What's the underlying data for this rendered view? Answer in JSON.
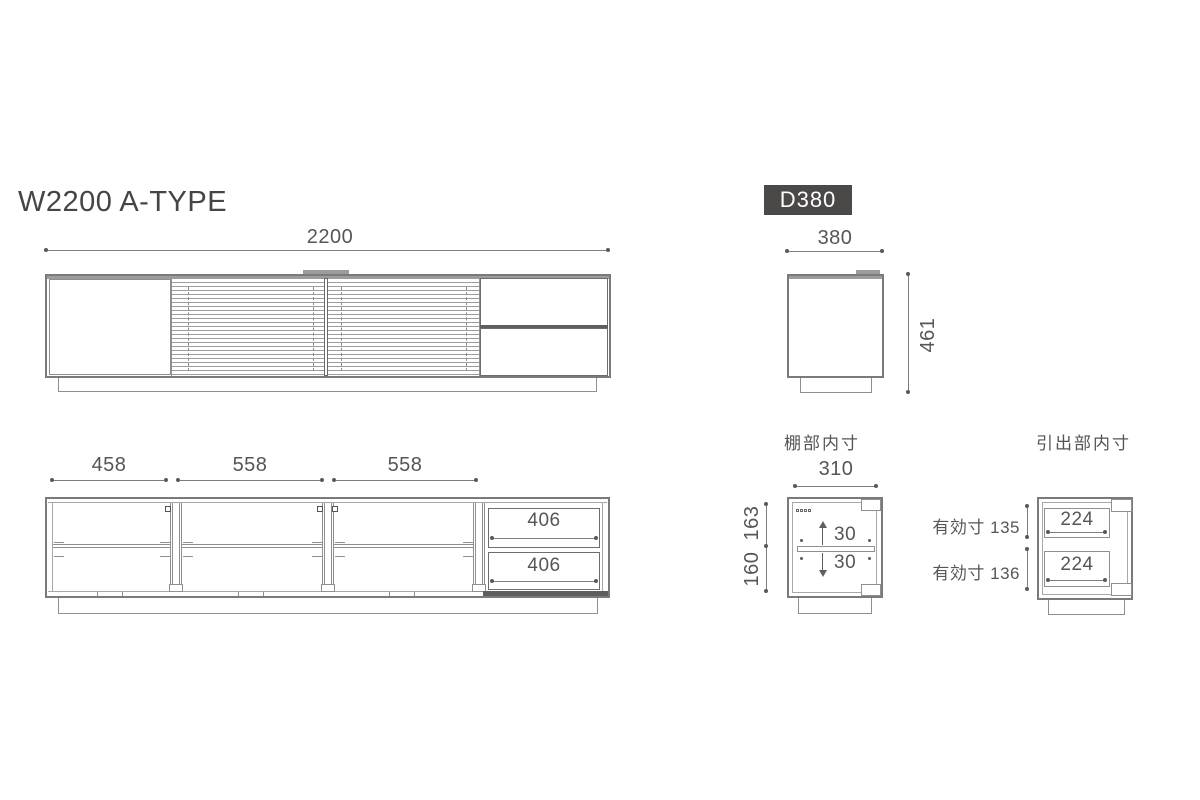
{
  "colors": {
    "line": "#8f8f8f",
    "dark_line": "#5f5f5f",
    "text": "#565656",
    "badge_bg": "#4b4848",
    "badge_text": "#ffffff"
  },
  "header": {
    "title": "W2200 A-TYPE",
    "badge": "D380"
  },
  "front_view": {
    "overall_width": "2200"
  },
  "front_internal": {
    "compartments": [
      "458",
      "558",
      "558"
    ],
    "drawers": [
      "406",
      "406"
    ]
  },
  "side_view": {
    "depth": "380",
    "height": "461"
  },
  "shelf_detail": {
    "title": "棚部内寸",
    "inner_width": "310",
    "upper_height": "163",
    "lower_height": "160",
    "shelf_pitch_up": "30",
    "shelf_pitch_down": "30"
  },
  "drawer_detail": {
    "title": "引出部内寸",
    "upper_label": "有効寸 135",
    "lower_label": "有効寸 136",
    "upper_width": "224",
    "lower_width": "224"
  }
}
